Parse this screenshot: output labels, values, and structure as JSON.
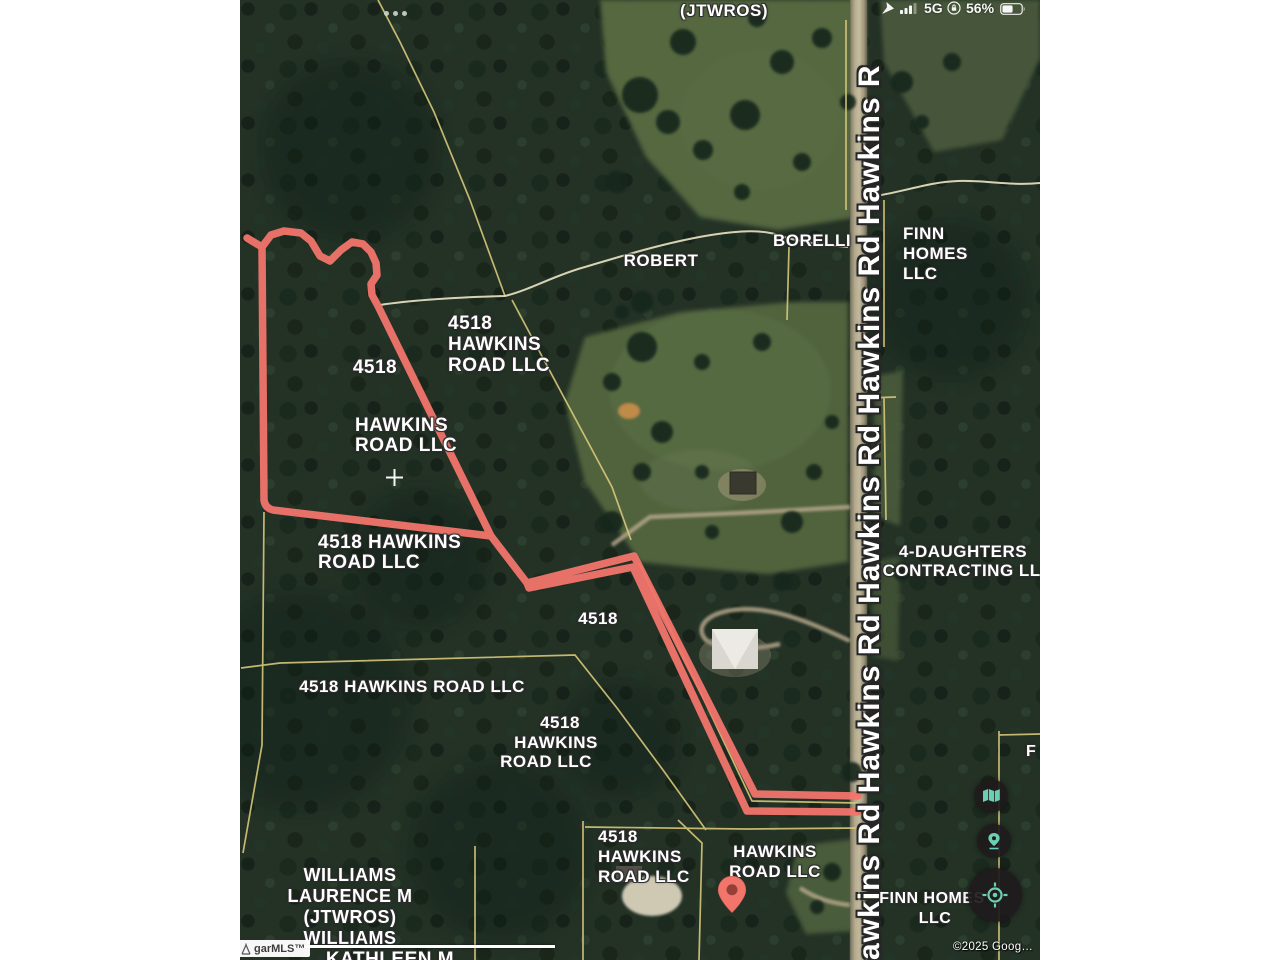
{
  "status_bar": {
    "dots": "•••",
    "network": "5G",
    "battery_percent": "56%",
    "icons": [
      "location-arrow-icon",
      "cellular-signal-icon",
      "orientation-lock-icon",
      "battery-icon"
    ]
  },
  "map": {
    "road_name": "Hawkins Rd",
    "road_label_repeat": "awkins Rd Hawkins Rd Hawkins Rd Hawkins Rd Hawkins R",
    "labels": {
      "jtwros": "(JTWROS)",
      "robert": "ROBERT",
      "borelli": "BORELLI",
      "finn_top": [
        "FINN",
        "HOMES",
        "LLC"
      ],
      "parcel_a": [
        "4518",
        "HAWKINS",
        "ROAD LLC"
      ],
      "parcel_b": "4518",
      "parcel_c": [
        "HAWKINS",
        "ROAD LLC"
      ],
      "parcel_d": [
        "4518 HAWKINS",
        "ROAD LLC"
      ],
      "daughters": [
        "4-DAUGHTERS",
        "CONTRACTING LLC"
      ],
      "parcel_e": "4518",
      "parcel_f": "4518 HAWKINS ROAD LLC",
      "parcel_g": [
        "4518",
        "HAWKINS",
        "ROAD LLC"
      ],
      "parcel_h": [
        "4518",
        "HAWKINS",
        "ROAD LLC"
      ],
      "parcel_i": [
        "HAWKINS",
        "ROAD LLC"
      ],
      "williams": [
        "WILLIAMS",
        "LAURENCE M",
        "(JTWROS)",
        "WILLIAMS"
      ],
      "kathleen": "KATHLEEN M",
      "f_clip": "F",
      "finn_bottom": [
        "FINN HOMES",
        "LLC"
      ]
    },
    "marker": "map-pin",
    "crosshair": "plus-crosshair"
  },
  "controls": {
    "map_view_button": "map-icon",
    "dropped_pin_button": "location-pin-icon",
    "locate_button": "gps-locate-icon"
  },
  "watermarks": {
    "mls": "garMLS™",
    "copyright": "©2025 Goog…"
  },
  "colors": {
    "highlight_red": "#f2756b",
    "parcel_line_yellow": "#dccb7c",
    "road_tan": "#c0b497",
    "forest_dark": "#243226",
    "field_green": "#55673f",
    "control_teal": "#6bcfb3",
    "control_bg": "#1f1b1c"
  }
}
